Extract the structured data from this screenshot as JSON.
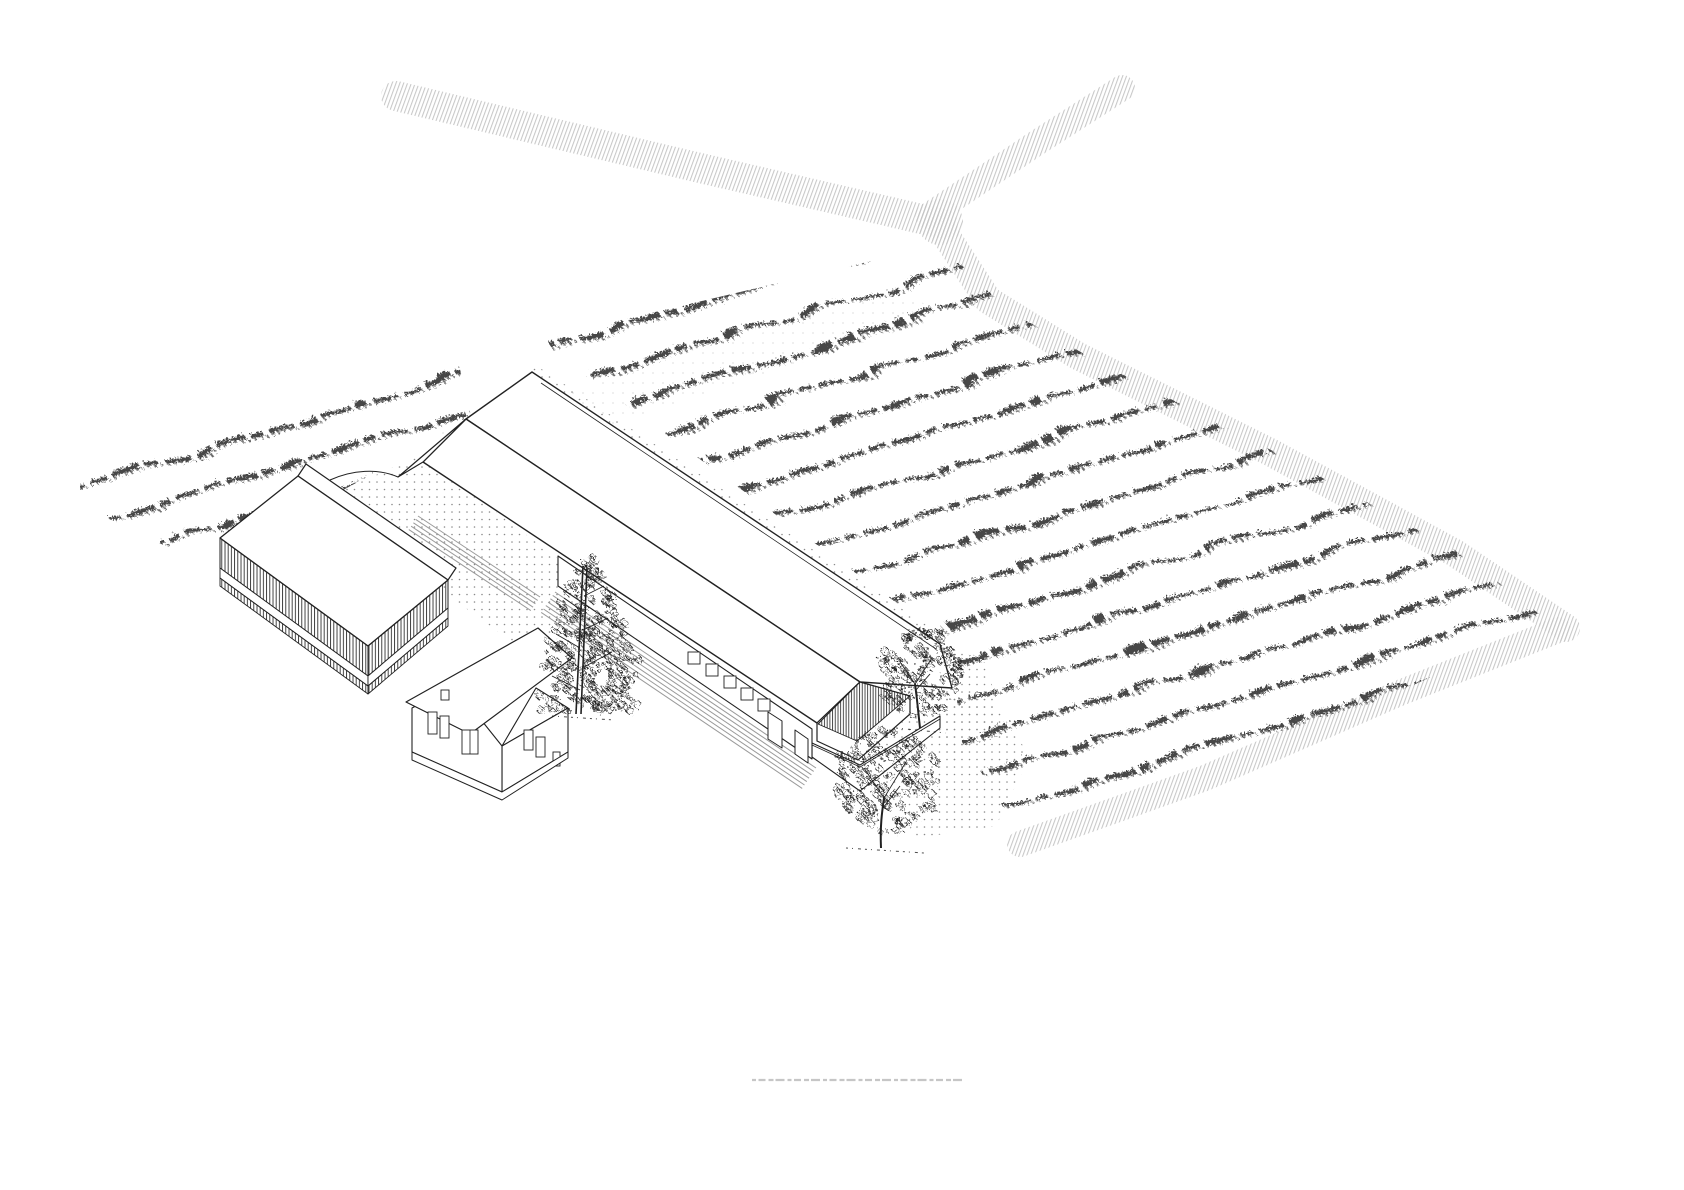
{
  "meta": {
    "title": "Axonometric farm-site line drawing with vineyard rows, barns, farmhouse, trees and field roads",
    "canvas_width": 1684,
    "canvas_height": 1190,
    "background": "#ffffff"
  },
  "palette": {
    "ink": "#222222",
    "row_ink": "#474747",
    "row_ink_light": "#6a6a6a",
    "road_hatch": "#c4c4c4",
    "stipple": "#8a8a8a",
    "stipple_light": "#9b9b9b",
    "apron": "#9a9a9a",
    "caption": "#a8a8a8",
    "white": "#ffffff"
  },
  "field": {
    "rows": {
      "count": 16,
      "qx": 523,
      "qy": 354,
      "step_x": 10.8,
      "step_y": 36.4,
      "dir_x": 0.9585,
      "dir_y": -0.2852,
      "span_back": 560,
      "span_fwd": 1160,
      "dash_main": "18 6 30 5 12 7 24 6",
      "dash_fine": "2.5 3.5",
      "width_main": 4.2,
      "width_fine": 1.7
    },
    "clip_regions": [
      "80,458 455,348 472,420 205,565 80,505",
      "545,338 918,250 940,244 1008,310 1098,362 1275,452 1462,554 1552,624 1404,689 1208,774 1024,840 962,742 950,642 556,354"
    ]
  },
  "roads": [
    {
      "name": "road-upper-left",
      "points": [
        [
          396,
          96
        ],
        [
          700,
          168
        ],
        [
          943,
          224
        ]
      ],
      "width": 30
    },
    {
      "name": "road-upper-right",
      "points": [
        [
          928,
          216
        ],
        [
          1035,
          144
        ],
        [
          1122,
          88
        ]
      ],
      "width": 26
    },
    {
      "name": "road-right-edge",
      "points": [
        [
          941,
          228
        ],
        [
          988,
          300
        ],
        [
          1078,
          356
        ],
        [
          1270,
          452
        ],
        [
          1455,
          553
        ],
        [
          1566,
          628
        ]
      ],
      "width": 28
    },
    {
      "name": "road-bottom-edge",
      "points": [
        [
          1020,
          844
        ],
        [
          1205,
          778
        ],
        [
          1402,
          692
        ],
        [
          1558,
          630
        ]
      ],
      "width": 26
    }
  ],
  "junction": {
    "x": 940,
    "y": 222,
    "r": 23
  },
  "stipple_areas": [
    {
      "name": "courtyard-gravel",
      "pattern": "dots",
      "opacity": 1,
      "points": "310,505 420,455 560,560 615,625 520,648 400,560"
    },
    {
      "name": "barn-north-strip",
      "pattern": "dots",
      "opacity": 1,
      "points": "534,364 946,638 934,654 524,380"
    },
    {
      "name": "barn-east-ground",
      "pattern": "dots",
      "opacity": 1,
      "points": "938,640 988,664 998,716 954,762 922,716 932,652"
    },
    {
      "name": "tree-ground",
      "pattern": "dots",
      "opacity": 1,
      "points": "886,688 992,700 1030,756 996,826 918,838 872,760"
    },
    {
      "name": "field-sprinkle",
      "pattern": "dots2",
      "opacity": 0.5,
      "points": "430,436 900,290 946,316 476,468"
    }
  ],
  "aprons": [
    {
      "name": "barn-front-apron",
      "x1": 555,
      "y1": 592,
      "x2": 816,
      "y2": 768,
      "n": 7,
      "ox": -2.3,
      "oy": 3.4
    },
    {
      "name": "courtyard-apron",
      "x1": 418,
      "y1": 516,
      "x2": 540,
      "y2": 597,
      "n": 5,
      "ox": -2.3,
      "oy": 3.4
    }
  ],
  "buildings": [
    {
      "name": "long-barn",
      "prims": [
        {
          "t": "poly",
          "p": "532,372 940,644 952,688 860,682 466,419",
          "f": "w",
          "sw": 1.4
        },
        {
          "t": "poly",
          "p": "466,419 860,682 817,723 423,462",
          "f": "w",
          "sw": 1.4
        },
        {
          "t": "line",
          "p": "541,383 936,649",
          "sw": 0.8
        },
        {
          "t": "poly",
          "p": "860,682 910,696 910,714 858,760 817,741 817,723",
          "f": "w",
          "sw": 1.2
        },
        {
          "t": "poly",
          "p": "860,682 910,696 857,741 818,724",
          "f": "g",
          "sw": 0.9
        },
        {
          "t": "poly",
          "p": "812,743 860,765 940,716 940,728 860,791 812,757",
          "f": "w",
          "sw": 1.1
        },
        {
          "t": "line",
          "p": "812,745 860,767",
          "sw": 0.8
        },
        {
          "t": "line",
          "p": "860,767 940,719",
          "sw": 0.8
        },
        {
          "t": "poly",
          "p": "558,556 812,729 812,759 558,586",
          "f": "w",
          "sw": 1.1
        },
        {
          "t": "r",
          "x": 688,
          "y": 652,
          "w": 12,
          "h": 12
        },
        {
          "t": "r",
          "x": 706,
          "y": 664,
          "w": 12,
          "h": 12
        },
        {
          "t": "r",
          "x": 724,
          "y": 676,
          "w": 12,
          "h": 12
        },
        {
          "t": "r",
          "x": 741,
          "y": 688,
          "w": 12,
          "h": 12
        },
        {
          "t": "r",
          "x": 758,
          "y": 699,
          "w": 12,
          "h": 12
        },
        {
          "t": "poly",
          "p": "768,712 782,721 782,748 768,739",
          "f": "w",
          "sw": 1
        },
        {
          "t": "poly",
          "p": "795,730 808,739 808,763 795,754",
          "f": "w",
          "sw": 1
        },
        {
          "t": "poly",
          "p": "466,419 423,462 398,477",
          "f": "w",
          "sw": 1.2
        },
        {
          "t": "path",
          "d": "M398,477 C378,468 352,470 330,480",
          "sw": 1
        }
      ]
    },
    {
      "name": "side-barn",
      "prims": [
        {
          "t": "poly",
          "p": "306,464 456,568 448,580 298,476",
          "f": "w",
          "sw": 1.2
        },
        {
          "t": "poly",
          "p": "298,476 448,580 368,646 220,538",
          "f": "w",
          "sw": 1.3
        },
        {
          "t": "poly",
          "p": "220,538 368,646 368,676 220,568",
          "f": "s",
          "sw": 1
        },
        {
          "t": "poly",
          "p": "368,646 448,580 448,608 368,676",
          "f": "s",
          "sw": 1
        },
        {
          "t": "poly",
          "p": "220,568 368,676 368,686 220,578",
          "f": "w",
          "sw": 0.9
        },
        {
          "t": "poly",
          "p": "368,676 448,608 448,618 368,686",
          "f": "w",
          "sw": 0.9
        },
        {
          "t": "poly",
          "p": "220,578 368,686 368,694 220,586",
          "f": "s",
          "sw": 0.9
        },
        {
          "t": "poly",
          "p": "368,686 448,618 448,626 368,694",
          "f": "s",
          "sw": 0.9
        }
      ]
    },
    {
      "name": "farmhouse",
      "prims": [
        {
          "t": "poly",
          "p": "502,746 568,708 536,688",
          "f": "w",
          "sw": 1.1
        },
        {
          "t": "poly",
          "p": "502,746 568,708 568,752 502,792",
          "f": "w",
          "sw": 1.1
        },
        {
          "t": "poly",
          "p": "412,708 454,686 502,746 502,792 412,752",
          "f": "w",
          "sw": 1.1
        },
        {
          "t": "poly",
          "p": "538,628 572,658 470,734 406,702",
          "f": "w",
          "sw": 1.2
        },
        {
          "t": "r",
          "x": 428,
          "y": 712,
          "w": 9,
          "h": 22
        },
        {
          "t": "r",
          "x": 440,
          "y": 716,
          "w": 9,
          "h": 22
        },
        {
          "t": "r",
          "x": 462,
          "y": 730,
          "w": 16,
          "h": 24
        },
        {
          "t": "line",
          "p": "470,730 470,754",
          "sw": 0.8
        },
        {
          "t": "r",
          "x": 441,
          "y": 690,
          "w": 8,
          "h": 10
        },
        {
          "t": "r",
          "x": 524,
          "y": 730,
          "w": 9,
          "h": 20
        },
        {
          "t": "r",
          "x": 536,
          "y": 737,
          "w": 9,
          "h": 20
        },
        {
          "t": "r",
          "x": 553,
          "y": 752,
          "w": 7,
          "h": 14
        },
        {
          "t": "poly",
          "p": "412,752 502,792 568,752 568,758 502,800 412,760",
          "f": "w",
          "sw": 1
        }
      ]
    }
  ],
  "trees": [
    {
      "name": "pine-tree",
      "kind": "pine",
      "seed": 7,
      "trunk": [
        [
          576,
          714,
          583,
          566
        ],
        [
          581,
          714,
          587,
          568
        ]
      ],
      "branches": [
        [
          580,
          690,
          552,
          676
        ],
        [
          582,
          668,
          612,
          652
        ],
        [
          580,
          648,
          556,
          634
        ],
        [
          583,
          630,
          608,
          618
        ],
        [
          581,
          610,
          564,
          598
        ],
        [
          584,
          596,
          604,
          586
        ]
      ],
      "layers": [
        [
          587,
          700,
          54
        ],
        [
          585,
          682,
          47
        ],
        [
          589,
          664,
          52
        ],
        [
          586,
          646,
          44
        ],
        [
          588,
          628,
          38
        ],
        [
          585,
          610,
          30
        ],
        [
          588,
          592,
          24
        ],
        [
          586,
          576,
          17
        ],
        [
          587,
          562,
          11
        ]
      ],
      "tufts": [
        552,
        716,
        614,
        720
      ]
    },
    {
      "name": "deciduous-tree-small",
      "kind": "round",
      "seed": 13,
      "cx": 916,
      "cy": 670,
      "rx": 42,
      "ry": 44,
      "n": 120,
      "trunkd": "M920,728 C918,710 917,698 915,684",
      "branches": [
        [
          915,
          684,
          900,
          662
        ],
        [
          915,
          684,
          932,
          658
        ],
        [
          916,
          690,
          930,
          674
        ]
      ],
      "tufts": [
        896,
        728,
        946,
        733
      ]
    },
    {
      "name": "deciduous-tree-large",
      "kind": "round",
      "seed": 29,
      "cx": 886,
      "cy": 778,
      "rx": 56,
      "ry": 52,
      "n": 155,
      "trunkd": "M881,848 C880,826 882,812 884,798",
      "branches": [
        [
          884,
          798,
          864,
          768
        ],
        [
          884,
          798,
          906,
          762
        ],
        [
          883,
          808,
          900,
          786
        ]
      ],
      "tufts": [
        846,
        848,
        924,
        853
      ]
    }
  ],
  "caption": {
    "x1": 752,
    "y1": 1080,
    "x2": 962,
    "y2": 1080,
    "dash": "4 2.5 7 3 5 2 9 3",
    "width": 2.2,
    "opacity": 0.65
  }
}
